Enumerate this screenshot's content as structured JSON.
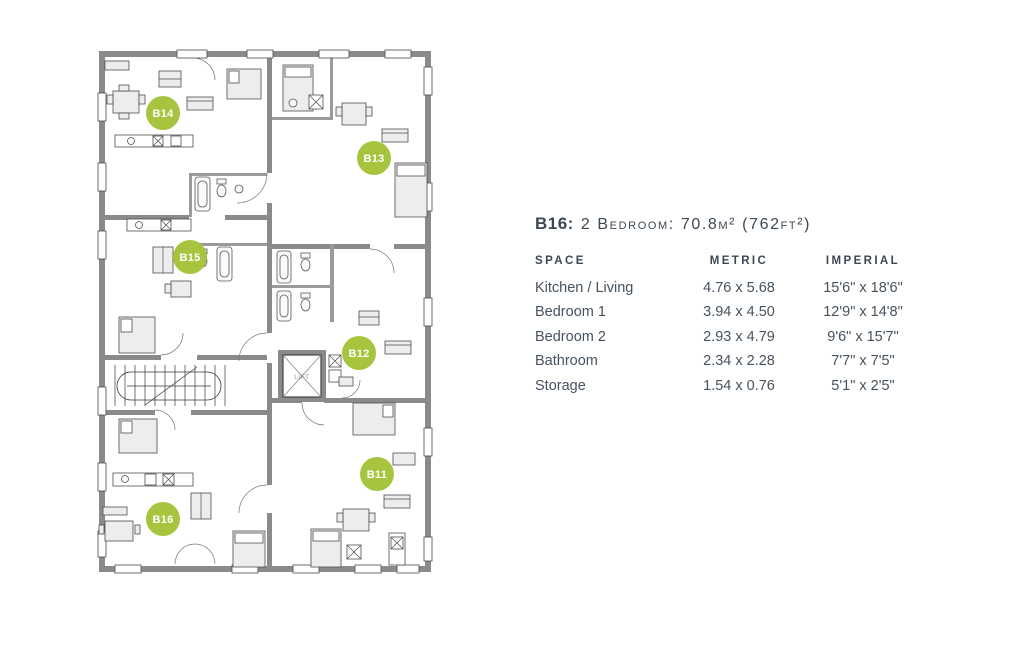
{
  "colors": {
    "accent_green": "#a6c43e",
    "wall_gray": "#8a8a8a",
    "text_dark": "#3d4854"
  },
  "floorplan": {
    "lift_label": "LIFT",
    "units": [
      {
        "label": "B14"
      },
      {
        "label": "B13"
      },
      {
        "label": "B15"
      },
      {
        "label": "B12"
      },
      {
        "label": "B11"
      },
      {
        "label": "B16"
      }
    ]
  },
  "panel": {
    "title_unit": "B16:",
    "title_desc": "2 Bedroom: 70.8m² (762ft²)",
    "table": {
      "headers": {
        "space": "SPACE",
        "metric": "METRIC",
        "imperial": "IMPERIAL"
      },
      "rows": [
        {
          "space": "Kitchen / Living",
          "metric": "4.76 x 5.68",
          "imperial": "15'6\" x 18'6\""
        },
        {
          "space": "Bedroom 1",
          "metric": "3.94 x 4.50",
          "imperial": "12'9\" x 14'8\""
        },
        {
          "space": "Bedroom 2",
          "metric": "2.93 x 4.79",
          "imperial": "9'6\" x 15'7\""
        },
        {
          "space": "Bathroom",
          "metric": "2.34 x 2.28",
          "imperial": "7'7\" x 7'5\""
        },
        {
          "space": "Storage",
          "metric": "1.54 x 0.76",
          "imperial": "5'1\" x 2'5\""
        }
      ]
    }
  }
}
